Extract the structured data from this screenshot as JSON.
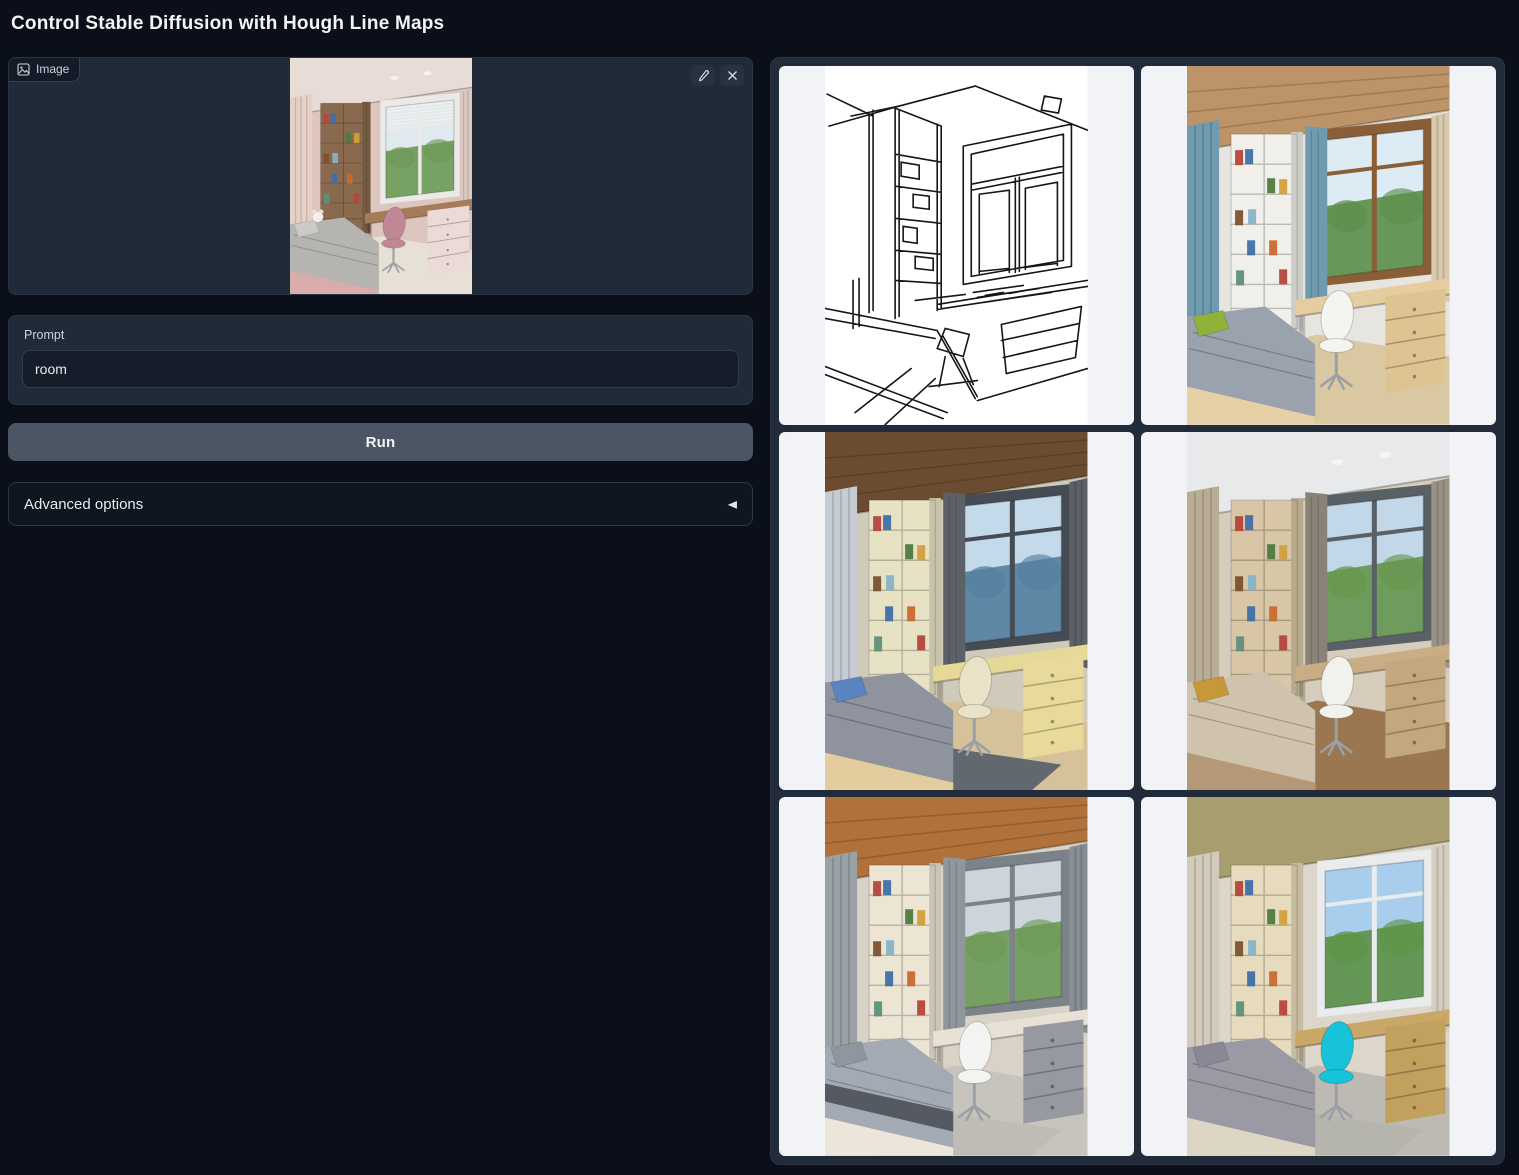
{
  "page": {
    "title": "Control Stable Diffusion with Hough Line Maps"
  },
  "colors": {
    "background": "#0b0f19",
    "block": "#212a38",
    "border": "#303b4c",
    "input_bg": "#151d2b",
    "text": "#e5e7eb",
    "label": "#cfd4dc",
    "run_button": "#4b5563",
    "gallery_background": "#212b3a",
    "cell_background": "#f2f3f6"
  },
  "icons": {
    "image_icon": "picture-frame",
    "edit_icon": "pencil",
    "clear_icon": "x",
    "accordion_collapsed_icon": "◀"
  },
  "image_input": {
    "label": "Image",
    "edit_button_label": "Edit",
    "clear_button_label": "Clear",
    "content": "photo of a pink children's bedroom with bookshelf, window, desk, pink chair and bed",
    "palette": {
      "wall": "#dcc6be",
      "ceiling": "#e8dcd7",
      "planks": false,
      "lights": true,
      "curtainL": "#e6d0c8",
      "drape": null,
      "curtainR": "#dcc8c0",
      "shelf": "#8a6a4e",
      "frame": "#eceae8",
      "sky": "#dfe9ee",
      "trees": "#6f9a58",
      "blinds": true,
      "desk": "#a67c58",
      "drawers": "#eadbd7",
      "chair": "#bf8894",
      "bed": "#b6b4b0",
      "pillow": "#cccac6",
      "blanket": null,
      "bedBase": "#d9acac",
      "floor": "#e7e0d5",
      "rug": null,
      "plush": true
    }
  },
  "prompt": {
    "label": "Prompt",
    "value": "room"
  },
  "run_button": {
    "label": "Run"
  },
  "advanced": {
    "label": "Advanced options"
  },
  "gallery": {
    "items": [
      {
        "name": "hough-line-map",
        "type": "linemap",
        "content": "black-on-white Hough line map of the room"
      },
      {
        "name": "generated-room-1",
        "type": "room",
        "content": "room with wood ceiling, blue curtains, green pillow",
        "palette": {
          "wall": "#e7e5e0",
          "ceiling": "#bd9468",
          "planks": true,
          "lights": false,
          "curtainL": "#6f9ab0",
          "drape": "#6f9ab0",
          "curtainR": "#d9c9ad",
          "shelf": "#f0efea",
          "frame": "#8a5f38",
          "sky": "#dcebf4",
          "trees": "#5d8f4c",
          "blinds": false,
          "desk": "#e6cda0",
          "drawers": "#dfc493",
          "chair": "#f4f4f1",
          "bed": "#9aa2ae",
          "pillow": "#8fb23a",
          "blanket": null,
          "bedBase": "#e7d0a6",
          "floor": "#d9c8a2",
          "rug": null,
          "plush": false
        }
      },
      {
        "name": "generated-room-2",
        "type": "room",
        "content": "room with dark wood ceiling, gray curtains, sea view, blue pillow",
        "palette": {
          "wall": "#cfcaba",
          "ceiling": "#6b4c30",
          "planks": true,
          "lights": false,
          "curtainL": "#c5ccd3",
          "drape": "#5c6168",
          "curtainR": "#5c6168",
          "shelf": "#e8e2c4",
          "frame": "#464c54",
          "sky": "#c4d9ea",
          "trees": "#56809f",
          "blinds": false,
          "desk": "#e6d998",
          "drawers": "#e8da9a",
          "chair": "#e9e2c6",
          "bed": "#8e939d",
          "pillow": "#5b84c2",
          "blanket": null,
          "bedBase": "#e3cc9e",
          "floor": "#d6c29a",
          "rug": "#62686f",
          "plush": false
        }
      },
      {
        "name": "generated-room-3",
        "type": "room",
        "content": "beige room with textured wall, tree view, mustard pillow",
        "palette": {
          "wall": "#d6cdbc",
          "ceiling": "#e8e9ea",
          "planks": false,
          "lights": true,
          "curtainL": "#b9ad96",
          "drape": "#8a8276",
          "curtainR": "#9b9286",
          "shelf": "#d8c6a6",
          "frame": "#5a6166",
          "sky": "#c2d8e8",
          "trees": "#67974f",
          "blinds": false,
          "desk": "#c9ae85",
          "drawers": "#c3a87e",
          "chair": "#f1f1ee",
          "bed": "#cfc3ad",
          "pillow": "#c69838",
          "blanket": null,
          "bedBase": "#b59877",
          "floor": "#9b7751",
          "rug": null,
          "plush": false
        }
      },
      {
        "name": "generated-room-4",
        "type": "room",
        "content": "room with orange wood ceiling, gray curtains and patterned gray bedding",
        "palette": {
          "wall": "#d9d2c6",
          "ceiling": "#b0713a",
          "planks": true,
          "lights": false,
          "curtainL": "#9aa1a7",
          "drape": "#8f969c",
          "curtainR": "#878e94",
          "shelf": "#ece5d4",
          "frame": "#7b8289",
          "sky": "#ccd6da",
          "trees": "#6f9a58",
          "blinds": false,
          "desk": "#e8e2d6",
          "drawers": "#969aa0",
          "chair": "#f3f3f1",
          "bed": "#a4aab4",
          "pillow": "#9096a0",
          "blanket": "#555a62",
          "bedBase": "#ece6da",
          "floor": "#c6c4bd",
          "rug": "#bebcb5",
          "plush": false
        }
      },
      {
        "name": "generated-room-5",
        "type": "room",
        "content": "room with olive textured ceiling, colorful books and bright cyan chair",
        "palette": {
          "wall": "#ddd6ca",
          "ceiling": "#a79d6e",
          "planks": false,
          "lights": false,
          "curtainL": "#d2cabb",
          "drape": null,
          "curtainR": "#d4cdc0",
          "shelf": "#e6dbbc",
          "frame": "#e9ebec",
          "sky": "#a9cdec",
          "trees": "#5e9348",
          "blinds": false,
          "desk": "#c9a767",
          "drawers": "#c2a05e",
          "chair": "#17c3d8",
          "bed": "#9b99a4",
          "pillow": "#8a8894",
          "blanket": null,
          "bedBase": "#ded6c4",
          "floor": "#bcbab2",
          "rug": "#b5b4ad",
          "plush": false
        }
      }
    ]
  }
}
